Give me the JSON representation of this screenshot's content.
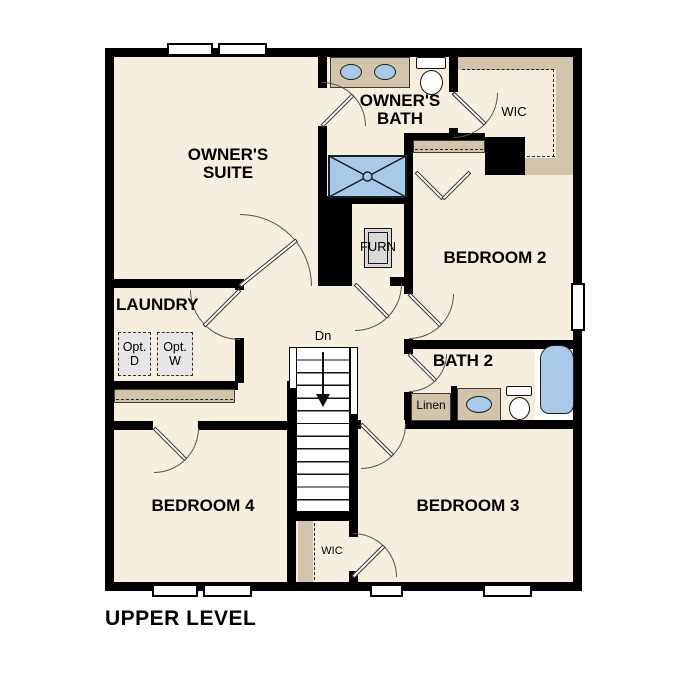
{
  "plan_title": "UPPER LEVEL",
  "colors": {
    "floor": "#f6eede",
    "wall": "#000000",
    "shelf_tan": "#d2c4aa",
    "fixture_blue": "#a9c9e8",
    "optional_gray": "#e6e6e6",
    "furnace_gray": "#d9d9d9"
  },
  "rooms": {
    "owners_suite": "OWNER'S\nSUITE",
    "owners_bath": "OWNER'S\nBATH",
    "wic_top": "WIC",
    "bedroom2": "BEDROOM 2",
    "furn": "FURN",
    "laundry": "LAUNDRY",
    "opt_dryer": "Opt.\nD",
    "opt_washer": "Opt.\nW",
    "bath2": "BATH 2",
    "linen": "Linen",
    "bedroom4": "BEDROOM 4",
    "bedroom3": "BEDROOM 3",
    "wic_bottom": "WIC",
    "stairs_down": "Dn"
  }
}
